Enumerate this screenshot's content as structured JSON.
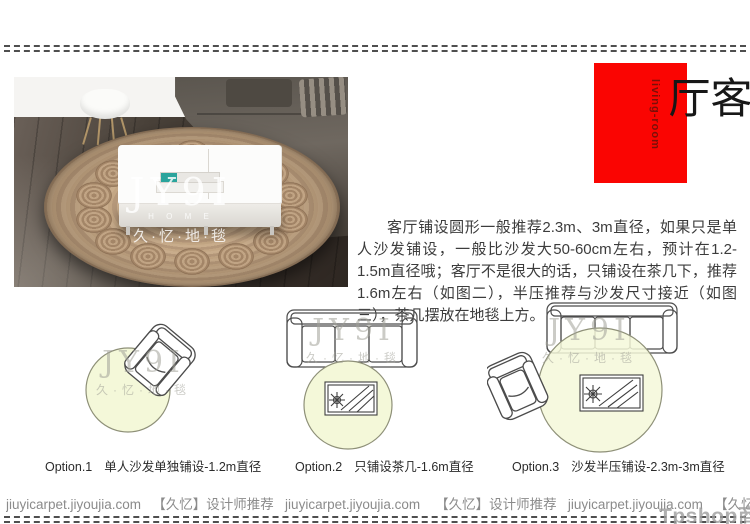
{
  "banner": {
    "title": "客厅",
    "subtitle": "living-room"
  },
  "photo_watermark": {
    "brand": "JY9I",
    "sub": "H O M E",
    "cn": "久·忆·地·毯"
  },
  "description": {
    "text": "客厅铺设圆形一般推荐2.3m、3m直径，如果只是单人沙发铺设，一般比沙发大50-60cm左右，预计在1.2-1.5m直径哦；客厅不是很大的话，只铺设在茶几下，推荐1.6m左右（如图二），半压推荐与沙发尺寸接近（如图三），茶几摆放在地毯上方。"
  },
  "diagram_watermark": {
    "brand": "JY9I",
    "cn": "久·忆·地·毯"
  },
  "options": [
    {
      "label": "Option.1",
      "text": "单人沙发单独铺设-1.2m直径"
    },
    {
      "label": "Option.2",
      "text": "只铺设茶几-1.6m直径"
    },
    {
      "label": "Option.3",
      "text": "沙发半压铺设-2.3m-3m直径"
    }
  ],
  "footer": {
    "text": "jiuyicarpet.jiyoujia.com   【久忆】设计师推荐   jiuyicarpet.jiyoujia.com    【久忆】设计师推荐   jiuyicarpet.jiyoujia.com   【久忆】设计师推荐   jiuyicarpet.jiyoujia.com"
  },
  "overlay": {
    "watermark": "Tpshop商城"
  },
  "colors": {
    "accent_red": "#fa0502",
    "circle_fill": "#f4f8d9",
    "circle_stroke": "#8e9078",
    "rug_tan": "#c4a787",
    "sofa_gray": "#6b645c",
    "floor_brown": "#453d35",
    "footer_gray": "#8b8b8b"
  }
}
